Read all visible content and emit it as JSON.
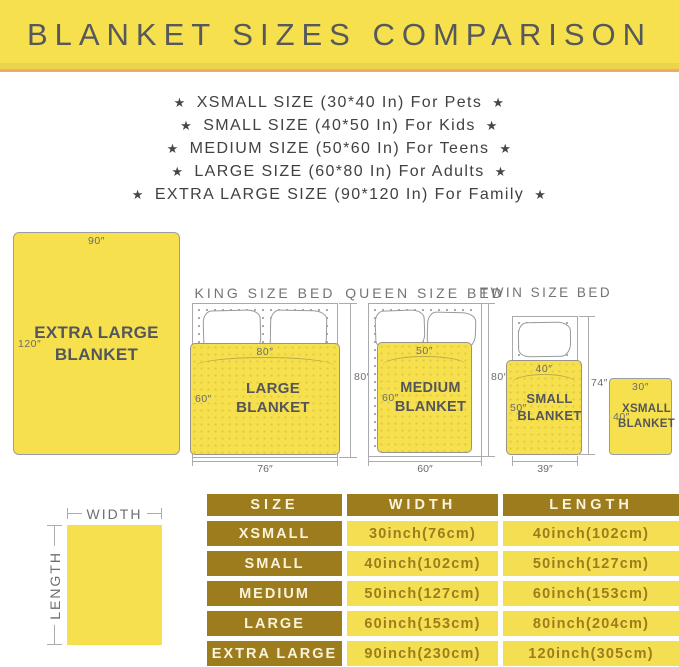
{
  "banner": {
    "title": "BLANKET SIZES COMPARISON"
  },
  "size_list": {
    "star_icon": "★",
    "items": [
      "XSMALL SIZE (30*40 In) For Pets",
      "SMALL SIZE (40*50 In) For Kids",
      "MEDIUM SIZE (50*60 In) For Teens",
      "LARGE SIZE (60*80 In) For Adults",
      "EXTRA LARGE SIZE (90*120 In) For Family"
    ]
  },
  "diagram": {
    "xl_blanket": {
      "width": "90″",
      "length": "120″",
      "name_line1": "EXTRA LARGE",
      "name_line2": "BLANKET"
    },
    "king": {
      "title": "KING SIZE BED",
      "blanket_width": "80″",
      "blanket_length": "60″",
      "blanket_name": "LARGE BLANKET",
      "bed_height": "80″",
      "bed_width": "76″"
    },
    "queen": {
      "title": "QUEEN SIZE BED",
      "blanket_width": "50″",
      "blanket_length": "60″",
      "name_line1": "MEDIUM",
      "name_line2": "BLANKET",
      "bed_height": "80″",
      "bed_width": "60″"
    },
    "twin": {
      "title": "TWIN SIZE BED",
      "blanket_width": "40″",
      "blanket_length": "50″",
      "name_line1": "SMALL",
      "name_line2": "BLANKET",
      "bed_height": "74″",
      "bed_width": "39″"
    },
    "xsmall": {
      "width": "30″",
      "length": "40″",
      "name_line1": "XSMALL",
      "name_line2": "BLANKET"
    }
  },
  "legend": {
    "width_label": "WIDTH",
    "length_label": "LENGTH"
  },
  "table": {
    "headers": [
      "SIZE",
      "WIDTH",
      "LENGTH"
    ],
    "rows": [
      {
        "size": "XSMALL",
        "width": "30inch(76cm)",
        "length": "40inch(102cm)"
      },
      {
        "size": "SMALL",
        "width": "40inch(102cm)",
        "length": "50inch(127cm)"
      },
      {
        "size": "MEDIUM",
        "width": "50inch(127cm)",
        "length": "60inch(153cm)"
      },
      {
        "size": "LARGE",
        "width": "60inch(153cm)",
        "length": "80inch(204cm)"
      },
      {
        "size": "EXTRA LARGE",
        "width": "90inch(230cm)",
        "length": "120inch(305cm)"
      }
    ]
  },
  "colors": {
    "yellow": "#F6E04E",
    "gold": "#9C7C1D",
    "orange_divider": "#F0A96B",
    "title_text": "#57585B",
    "label_gray": "#6D6E71"
  }
}
